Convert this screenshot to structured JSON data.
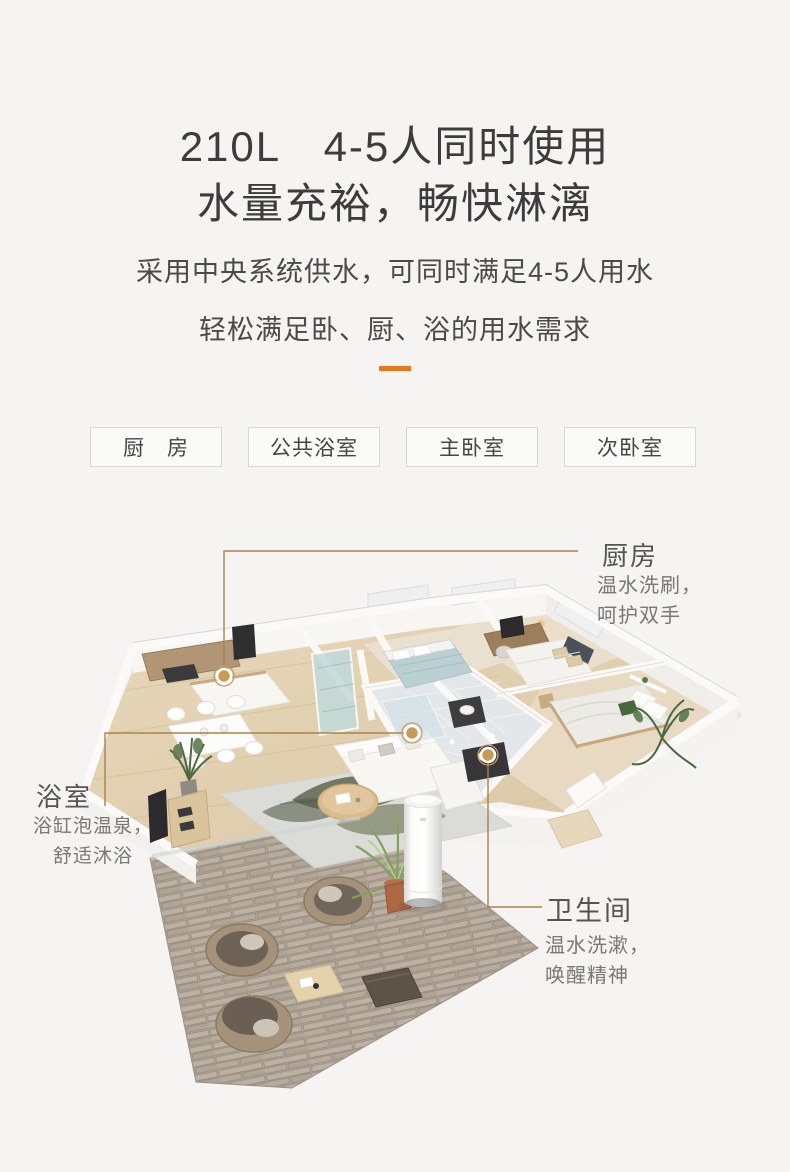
{
  "page": {
    "background": "#F5F4F2"
  },
  "header": {
    "title_line1": "210L　4-5人同时使用",
    "title_line2": "水量充裕，畅快淋漓",
    "subtitle_line1": "采用中央系统供水，可同时满足4-5人用水",
    "subtitle_line2": "轻松满足卧、厨、浴的用水需求",
    "divider_color": "#E8791A"
  },
  "room_tags": {
    "kitchen": "厨　房",
    "public_bath": "公共浴室",
    "master_bedroom": "主卧室",
    "second_bedroom": "次卧室"
  },
  "callouts": {
    "kitchen": {
      "title": "厨房",
      "line1": "温水洗刷，",
      "line2": "呵护双手"
    },
    "bathroom": {
      "title": "浴室",
      "line1": "浴缸泡温泉，",
      "line2": "舒适沐浴"
    },
    "toilet": {
      "title": "卫生间",
      "line1": "温水洗漱，",
      "line2": "唤醒精神"
    }
  },
  "floor_plan": {
    "marker_color": "#C79B55",
    "leader_line_color": "#A8834C"
  }
}
